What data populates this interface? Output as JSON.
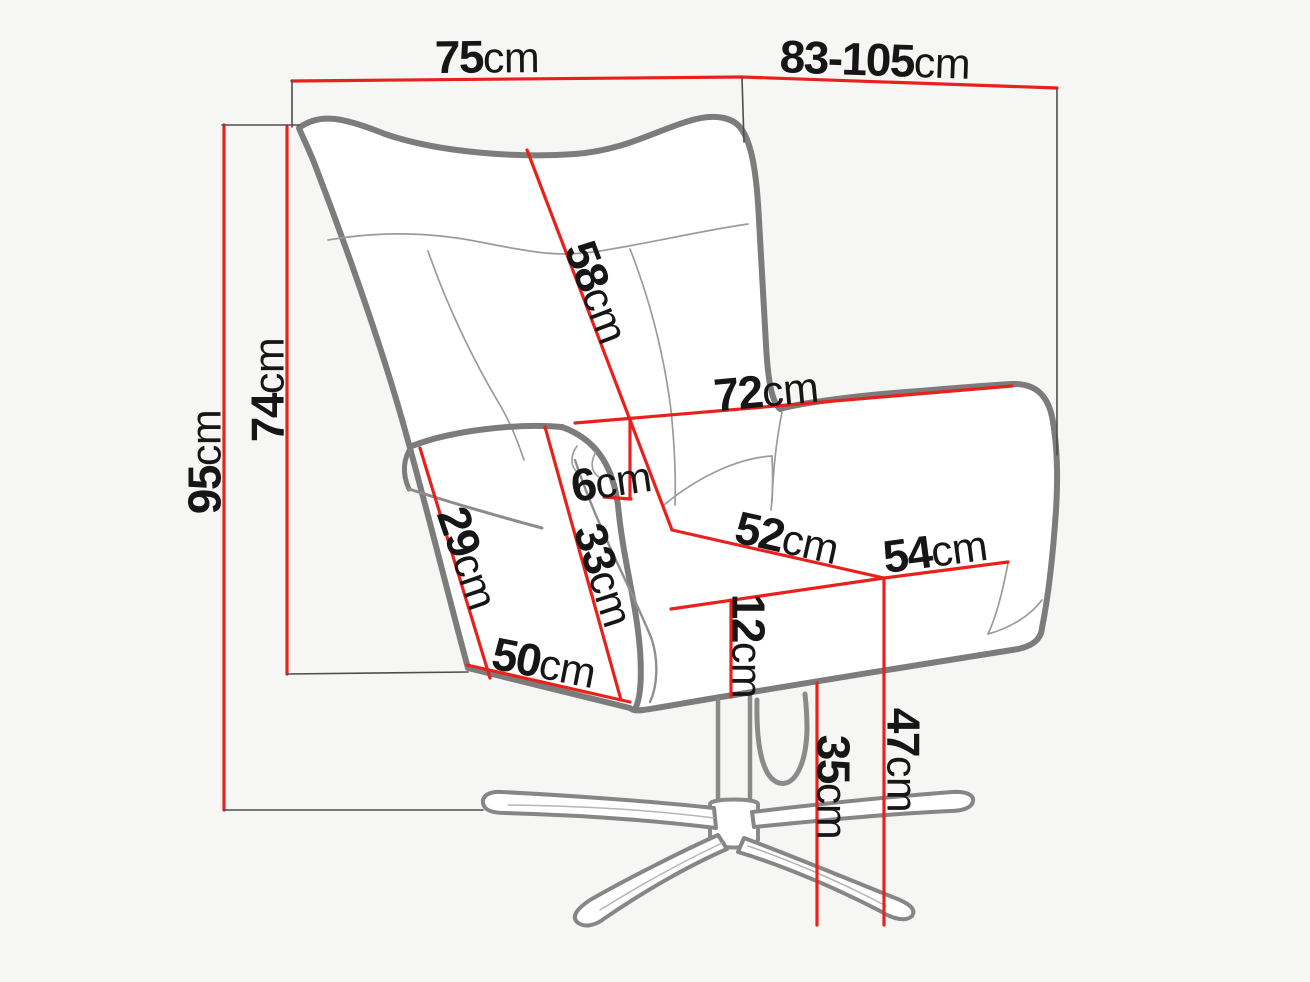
{
  "diagram": {
    "unit": "cm",
    "colors": {
      "dimension_line": "#e8211d",
      "chair_outline": "#7c7c7c",
      "seam_line": "#9b9b9b",
      "extension_line": "#4d4d4d",
      "label_text": "#161616",
      "background": "#f6f6f5"
    },
    "dimensions": {
      "overall_width_top": {
        "value": "75",
        "unit": "cm"
      },
      "overall_depth_range": {
        "value": "83-105",
        "unit": "cm"
      },
      "overall_height": {
        "value": "95",
        "unit": "cm"
      },
      "backrest_height": {
        "value": "74",
        "unit": "cm"
      },
      "backrest_diagonal": {
        "value": "58",
        "unit": "cm"
      },
      "inner_width": {
        "value": "72",
        "unit": "cm"
      },
      "armrest_top_width": {
        "value": "6",
        "unit": "cm"
      },
      "armrest_side_depth": {
        "value": "29",
        "unit": "cm"
      },
      "armrest_front_height": {
        "value": "33",
        "unit": "cm"
      },
      "front_base_width": {
        "value": "50",
        "unit": "cm"
      },
      "seat_width": {
        "value": "52",
        "unit": "cm"
      },
      "seat_depth": {
        "value": "54",
        "unit": "cm"
      },
      "seat_cushion_thickness": {
        "value": "12",
        "unit": "cm"
      },
      "underseat_clearance": {
        "value": "35",
        "unit": "cm"
      },
      "seat_height": {
        "value": "47",
        "unit": "cm"
      }
    }
  }
}
